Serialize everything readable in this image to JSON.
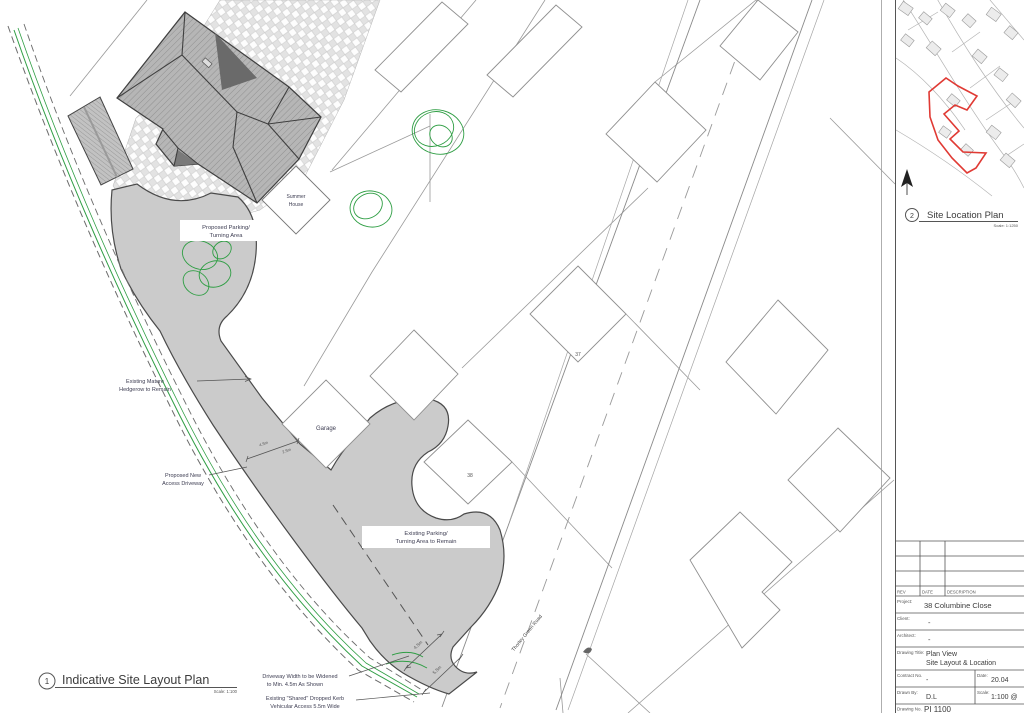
{
  "plan_titles": {
    "layout": {
      "number": "1",
      "title": "Indicative Site Layout Plan",
      "scale": "Scale: 1:100"
    },
    "location": {
      "number": "2",
      "title": "Site Location Plan",
      "scale": "Scale: 1:1250"
    }
  },
  "site_labels": {
    "proposed_parking_line1": "Proposed Parking/",
    "proposed_parking_line2": "Turning Area",
    "summer_house_line1": "Summer",
    "summer_house_line2": "House",
    "hedgerow_line1": "Existing Mature",
    "hedgerow_line2": "Hedgerow to Remain",
    "new_access_line1": "Proposed New",
    "new_access_line2": "Access Driveway",
    "garage": "Garage",
    "plot_37": "37",
    "plot_38": "38",
    "existing_parking_line1": "Existing Parking/",
    "existing_parking_line2": "Turning Area to Remain",
    "widen_line1": "Driveway Width to be Widened",
    "widen_line2": "to Min. 4.5m As Shown",
    "kerb_line1": "Existing \"Shared\" Dropped Kerb",
    "kerb_line2": "Vehicular Access 5.5m Wide",
    "road_name": "Thorley Green Road",
    "dim_driveway_a": "4.5m",
    "dim_driveway_b": "2.5m",
    "dim_access_width": "4.5m",
    "dim_kerb_width": "5.5m"
  },
  "title_block": {
    "rev_header": "REV",
    "date_header": "DATE",
    "description_header": "DESCRIPTION",
    "project_label": "Project:",
    "project_value": "38 Columbine Close",
    "client_label": "Client:",
    "client_value": "-",
    "architect_label": "Architect:",
    "architect_value": "-",
    "drawing_title_label": "Drawing Title:",
    "drawing_title_line1": "Plan View",
    "drawing_title_line2": "Site Layout & Location",
    "contract_label": "Contract No.",
    "contract_value": "-",
    "date_label": "Date:",
    "date_value": "20.04",
    "drawn_label": "Drawn By:",
    "drawn_value": "D.L",
    "scale_label": "Scale:",
    "scale_value": "1:100 @",
    "drawing_no_label": "Drawing No.",
    "drawing_no_value": "PI 1100"
  },
  "colors": {
    "site_outline_red": "#e03a34",
    "landscape_green": "#2f9e44",
    "surface_grey": "#cbcbcb"
  }
}
